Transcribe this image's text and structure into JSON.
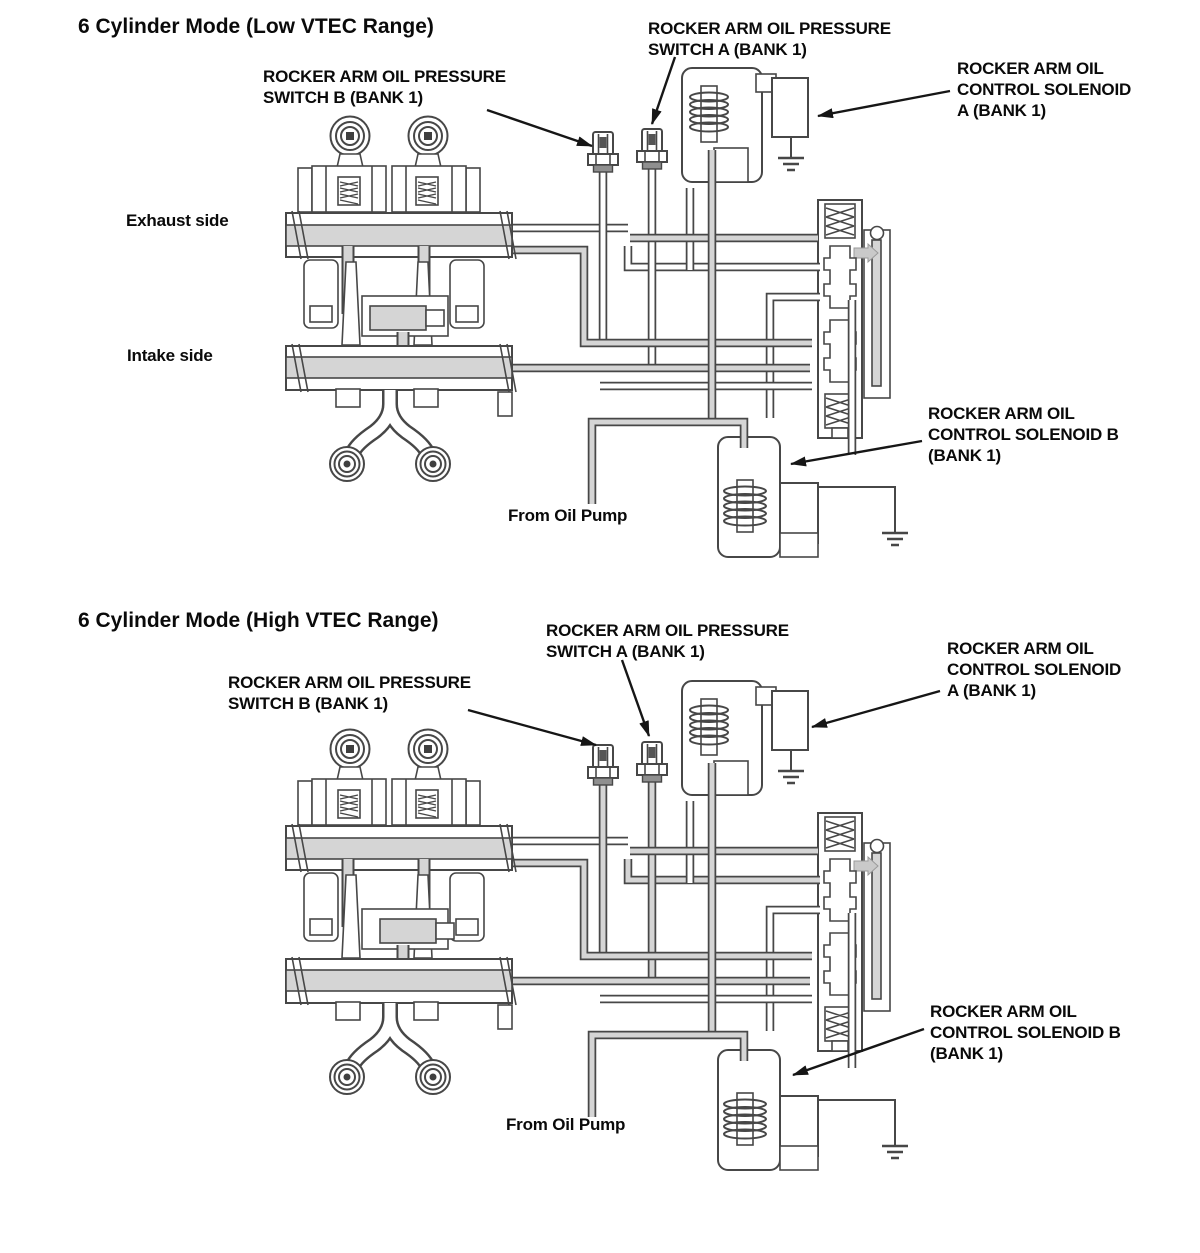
{
  "page": {
    "background": "#ffffff"
  },
  "colors": {
    "line": "#474747",
    "oil_passage": "#d5d5d5",
    "text": "#0a0a0a"
  },
  "diagrams": [
    {
      "id": "low-vtec",
      "title": "6 Cylinder Mode (Low VTEC Range)",
      "labels": {
        "switch_b": "ROCKER ARM OIL PRESSURE\nSWITCH B (BANK 1)",
        "switch_a": "ROCKER ARM OIL PRESSURE\nSWITCH A (BANK 1)",
        "solenoid_a": "ROCKER ARM OIL\nCONTROL SOLENOID\nA (BANK 1)",
        "solenoid_b": "ROCKER ARM OIL\nCONTROL SOLENOID B\n(BANK 1)",
        "exhaust_side": "Exhaust side",
        "intake_side": "Intake side",
        "from_oil_pump": "From Oil Pump"
      }
    },
    {
      "id": "high-vtec",
      "title": "6 Cylinder Mode (High VTEC Range)",
      "labels": {
        "switch_b": "ROCKER ARM OIL PRESSURE\nSWITCH B (BANK 1)",
        "switch_a": "ROCKER ARM OIL PRESSURE\nSWITCH A (BANK 1)",
        "solenoid_a": "ROCKER ARM OIL\nCONTROL SOLENOID\nA (BANK 1)",
        "solenoid_b": "ROCKER ARM OIL\nCONTROL SOLENOID B\n(BANK 1)",
        "from_oil_pump": "From Oil Pump"
      }
    }
  ]
}
